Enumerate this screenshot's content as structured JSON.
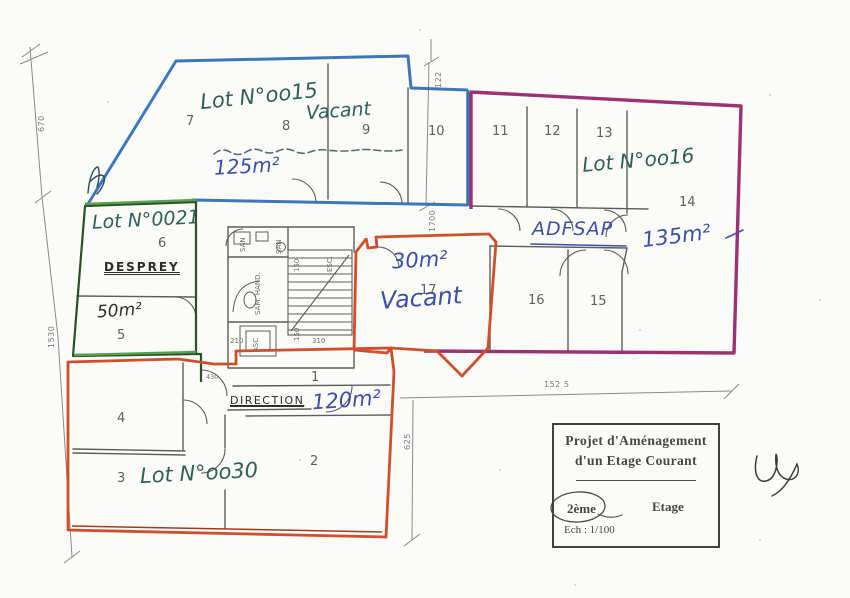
{
  "page": {
    "background": "#fbfbf8"
  },
  "title_block": {
    "line1": "Projet d'Aménagement",
    "line2": "d'un Etage Courant",
    "floor": "2ème",
    "floor_word": "Etage",
    "scale": "Ech : 1/100"
  },
  "lots": {
    "lot_0015": {
      "name": "Lot N°oo15",
      "status": "Vacant",
      "area": "125m²",
      "outline": "#2e6cb6"
    },
    "lot_0016": {
      "name": "Lot N°oo16",
      "tenant": "ADFSAP",
      "area": "135m²",
      "outline": "#97276e"
    },
    "lot_0021": {
      "name": "Lot N°0021",
      "tenant": "DESPREY",
      "area": "50m²",
      "outline": "#2c4f2a"
    },
    "lot_0030": {
      "name": "Lot N°oo30",
      "tenant": "DIRECTION",
      "area": "120m²",
      "outline": "#cf4e2c"
    },
    "lot_center": {
      "area": "30m²",
      "status": "Vacant",
      "outline": "#cf4e2c"
    }
  },
  "rooms": [
    "1",
    "2",
    "3",
    "4",
    "5",
    "6",
    "7",
    "8",
    "9",
    "10",
    "11",
    "12",
    "13",
    "14",
    "15",
    "16",
    "17"
  ],
  "core": {
    "san_a": "SAN",
    "san_b": "SAN",
    "sam_hand": "SAM. HAND.",
    "asc": "ASC",
    "esc": "ESC."
  },
  "dims": {
    "left_upper": "670",
    "left_lower": "1530",
    "top_width": "122",
    "room10_height": "1700",
    "bottom_width": "152 5",
    "bottom_height": "625",
    "d430": "430",
    "d210": "210",
    "d310": "310",
    "d150_a": "150",
    "d150_b": "150"
  }
}
